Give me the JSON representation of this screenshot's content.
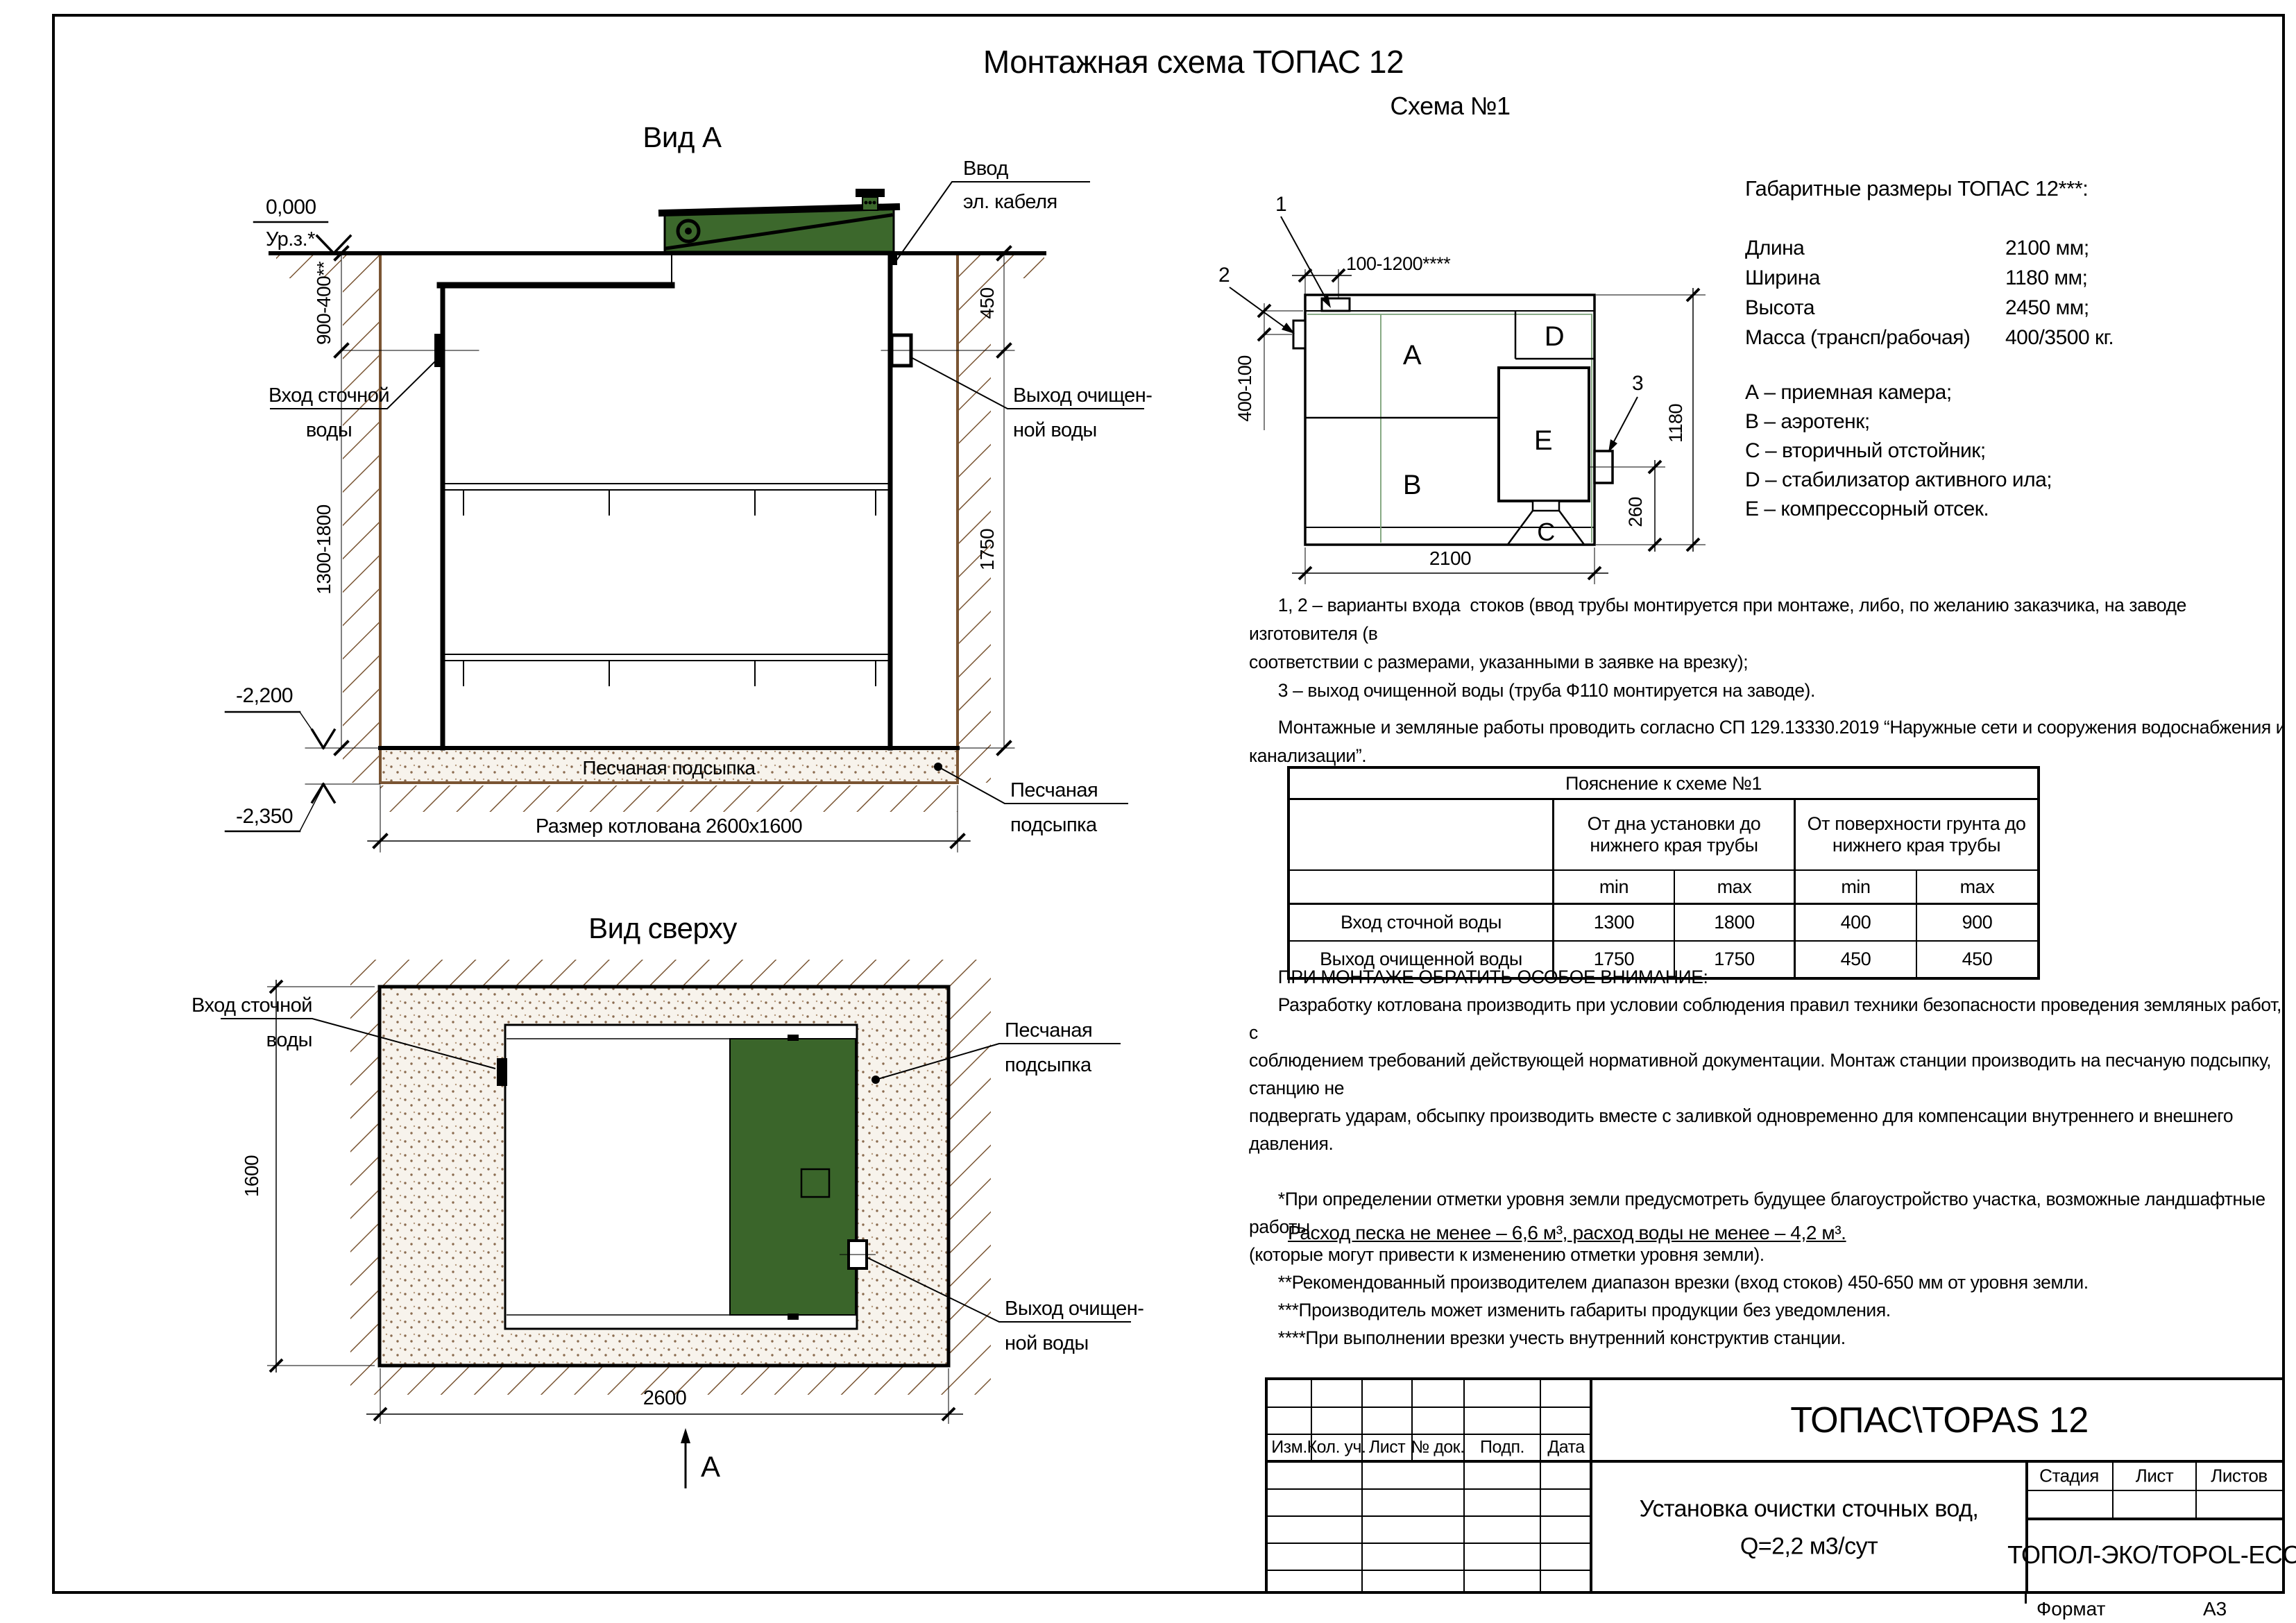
{
  "sheet": {
    "title": "Монтажная схема ТОПАС 12",
    "format_label": "Формат",
    "format_value": "А3"
  },
  "side_view": {
    "title": "Вид А",
    "elev_zero": "0,000",
    "ground_mark": "Ур.з.*",
    "cable_label_1": "Ввод",
    "cable_label_2": "эл. кабеля",
    "inlet_label_1": "Вход сточной",
    "inlet_label_2": "воды",
    "outlet_label_1": "Выход очищен-",
    "outlet_label_2": "ной воды",
    "dim_depth_top": "900-400**",
    "dim_depth_bottom": "1300-1800",
    "dim_out_top": "450",
    "dim_out_bottom": "1750",
    "elev_tank_bottom": "-2,200",
    "elev_pit_bottom": "-2,350",
    "sand_text": "Песчаная подсыпка",
    "sand_label_1": "Песчаная",
    "sand_label_2": "подсыпка",
    "pit_dim": "Размер котлована 2600х1600"
  },
  "schema": {
    "title": "Схема №1",
    "marks": {
      "m1": "1",
      "m2": "2",
      "m3": "3"
    },
    "compartments": {
      "a": "А",
      "b": "В",
      "c": "С",
      "d": "D",
      "e": "Е"
    },
    "dims": {
      "top": "100-1200****",
      "left": "400-100",
      "height": "1180",
      "outlet": "260",
      "length": "2100"
    }
  },
  "specs": {
    "heading": "Габаритные размеры ТОПАС 12***:",
    "rows": [
      {
        "label": "Длина",
        "value": "2100 мм;"
      },
      {
        "label": "Ширина",
        "value": "1180 мм;"
      },
      {
        "label": "Высота",
        "value": "2450 мм;"
      },
      {
        "label": "Масса (трансп/рабочая)",
        "value": "400/3500 кг."
      }
    ],
    "legend": [
      "А – приемная камера;",
      "В – аэротенк;",
      "С – вторичный отстойник;",
      "D – стабилизатор активного ила;",
      "Е – компрессорный отсек."
    ]
  },
  "notes": {
    "variants": "      1, 2 – варианты входа  стоков (ввод трубы монтируется при монтаже, либо, по желанию заказчика, на заводе изготовителя (в\nсоответствии с размерами, указанными в заявке на врезку);\n      3 – выход очищенной воды (труба Ф110 монтируется на заводе).",
    "norms": "      Монтажные и земляные работы проводить согласно СП 129.13330.2019 “Наружные сети и сооружения водоснабжения и канализации”."
  },
  "table": {
    "title": "Пояснение к схеме №1",
    "group1": "От дна установки до\nнижнего края трубы",
    "group2": "От поверхности грунта до\nнижнего края трубы",
    "min1": "min",
    "max1": "max",
    "min2": "min",
    "max2": "max",
    "rows": [
      [
        "Вход сточной воды",
        "1300",
        "1800",
        "400",
        "900"
      ],
      [
        "Выход очищенной воды",
        "1750",
        "1750",
        "450",
        "450"
      ]
    ]
  },
  "attention": "      ПРИ МОНТАЖЕ ОБРАТИТЬ ОСОБОЕ ВНИМАНИЕ:\n      Разработку котлована производить при условии соблюдения правил техники безопасности проведения земляных работ, с\nсоблюдением требований действующей нормативной документации. Монтаж станции производить на песчаную подсыпку, станцию не\nподвергать ударам, обсыпку производить вместе с заливкой одновременно для компенсации внутреннего и внешнего давления.\n\n      *При определении отметки уровня земли предусмотреть будущее благоустройство участка, возможные ландшафтные работы\n(которые могут привести к изменению отметки уровня земли).\n      **Рекомендованный производителем диапазон врезки (вход стоков) 450-650 мм от уровня земли.\n      ***Производитель может изменить габариты продукции без уведомления.\n      ****При выполнении врезки учесть внутренний конструктив станции.",
  "consumption": "Расход песка не менее – 6,6 м³, расход воды не менее – 4,2 м³.",
  "top_view": {
    "title": "Вид сверху",
    "inlet_label_1": "Вход сточной",
    "inlet_label_2": "воды",
    "outlet_label_1": "Выход очищен-",
    "outlet_label_2": "ной воды",
    "sand_label_1": "Песчаная",
    "sand_label_2": "подсыпка",
    "dim_width": "1600",
    "dim_length": "2600",
    "section_mark": "А"
  },
  "title_block": {
    "doc_title": "ТОПАС\\TOPAS 12",
    "subtitle_1": "Установка очистки сточных вод,",
    "subtitle_2": "Q=2,2 м3/сут",
    "company": "ТОПОЛ-ЭКО/TOPOL-ECO",
    "cols": [
      "Изм.",
      "Кол. уч.",
      "Лист",
      "№ док.",
      "Подп.",
      "Дата"
    ],
    "stage": "Стадия",
    "sheet": "Лист",
    "sheets": "Листов"
  }
}
